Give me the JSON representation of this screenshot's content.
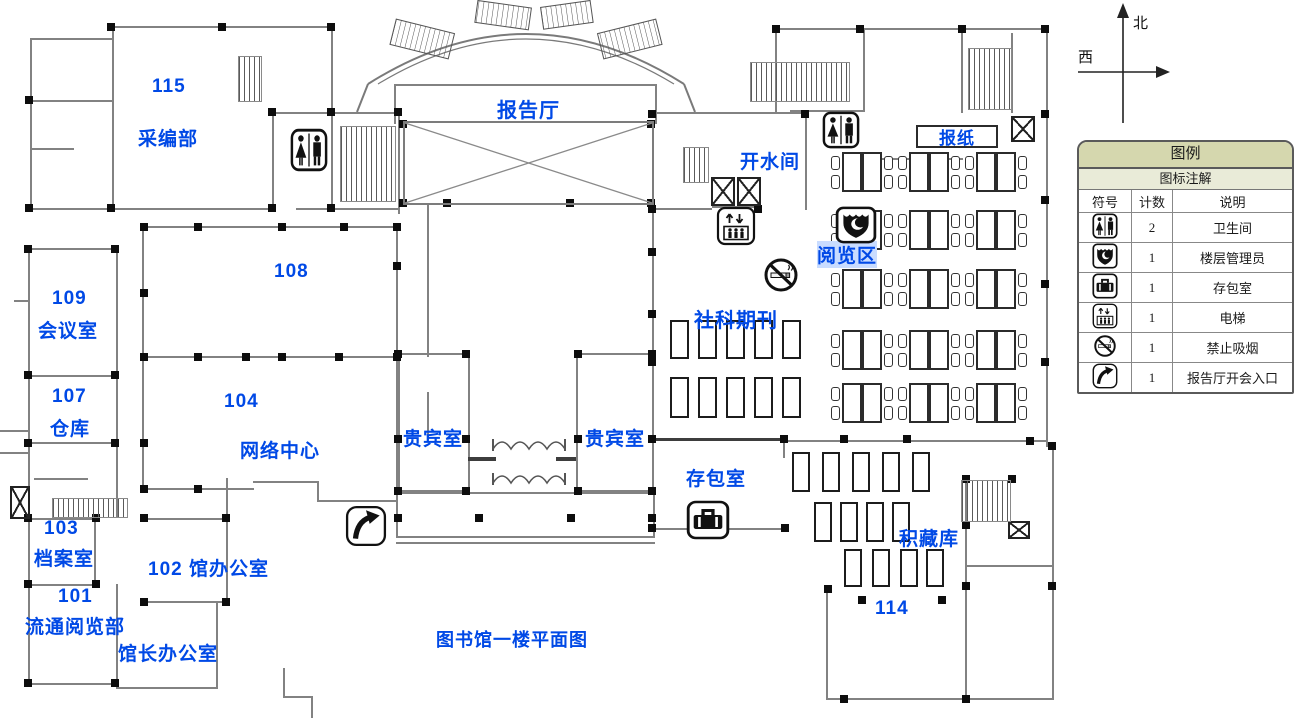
{
  "plan_title": "图书馆一楼平面图",
  "compass": {
    "north": "北",
    "west": "西"
  },
  "rooms": [
    {
      "number": "115",
      "name": "采编部"
    },
    {
      "number": "109",
      "name": "会议室"
    },
    {
      "number": "107",
      "name": "仓库"
    },
    {
      "number": "108",
      "name": ""
    },
    {
      "number": "104",
      "name": "网络中心"
    },
    {
      "number": "103",
      "name": "档案室"
    },
    {
      "number": "101",
      "name": "流通阅览部"
    },
    {
      "label": "102 馆办公室"
    },
    {
      "number": "114"
    },
    {
      "label": "馆长办公室"
    }
  ],
  "areas": {
    "lecture_hall": "报告厅",
    "hot_water_room": "开水间",
    "newspaper": "报纸",
    "reading_area": "阅览区",
    "social_periodicals": "社科期刊",
    "vip_room_left": "贵宾室",
    "vip_room_right": "贵宾室",
    "bag_storage": "存包室",
    "stack_room": "积藏库"
  },
  "legend": {
    "title": "图例",
    "subtitle": "图标注解",
    "columns": [
      "符号",
      "计数",
      "说明"
    ],
    "rows": [
      {
        "icon": "restroom-icon",
        "count": "2",
        "label": "卫生间"
      },
      {
        "icon": "floor-manager-icon",
        "count": "1",
        "label": "楼层管理员"
      },
      {
        "icon": "bag-storage-icon",
        "count": "1",
        "label": "存包室"
      },
      {
        "icon": "elevator-icon",
        "count": "1",
        "label": "电梯"
      },
      {
        "icon": "no-smoking-icon",
        "count": "1",
        "label": "禁止吸烟"
      },
      {
        "icon": "lecture-entrance-icon",
        "count": "1",
        "label": "报告厅开会入口"
      }
    ]
  },
  "colors": {
    "label_blue": "#0049e6",
    "wall_gray": "#828282",
    "legend_header_bg": "#d5d7ae",
    "legend_sub_bg": "#e9ebd8"
  }
}
